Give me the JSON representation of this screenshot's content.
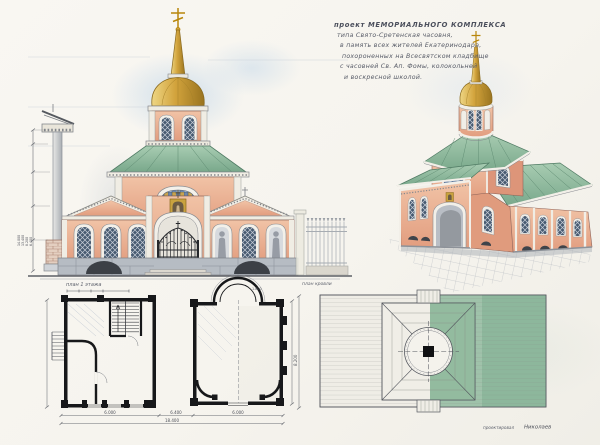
{
  "sheet": {
    "kind": "hand-drawn architectural presentation sheet of a memorial chapel",
    "title_block": {
      "lines": [
        "проект МЕМОРИАЛЬНОГО КОМПЛЕКСА",
        "типа Свято-Сретенская часовня,",
        "в память всех жителей Екатеринодара,",
        "похороненных на Всесвятском кладбище",
        "с часовней Св. Ап. Фомы, колокольней",
        "и воскресной школой."
      ]
    },
    "labels": {
      "floor_plan": "план 1 этажа",
      "roof_plan": "план кровли"
    },
    "signature": {
      "role": "проектировал",
      "name": "Николаев"
    },
    "dimensions": {
      "column_heights": [
        "14.000",
        "13.400",
        "8.200",
        "6.400"
      ],
      "plan_widths": [
        "6.000",
        "6.400",
        "6.000"
      ],
      "plan_total_width": "18.400",
      "hall_depth": "8.200",
      "apse_width": "1.800"
    },
    "palette": {
      "wall_pink": "#e9ab8d",
      "roof_green": "#8fb99c",
      "dome_gold": "#d2a33c",
      "window_blue": "#46566a",
      "stone_grey": "#a9aeb6",
      "sky_blue": "#cfe0ee",
      "ink": "#3c4046",
      "paper": "#f6f4ee"
    }
  }
}
